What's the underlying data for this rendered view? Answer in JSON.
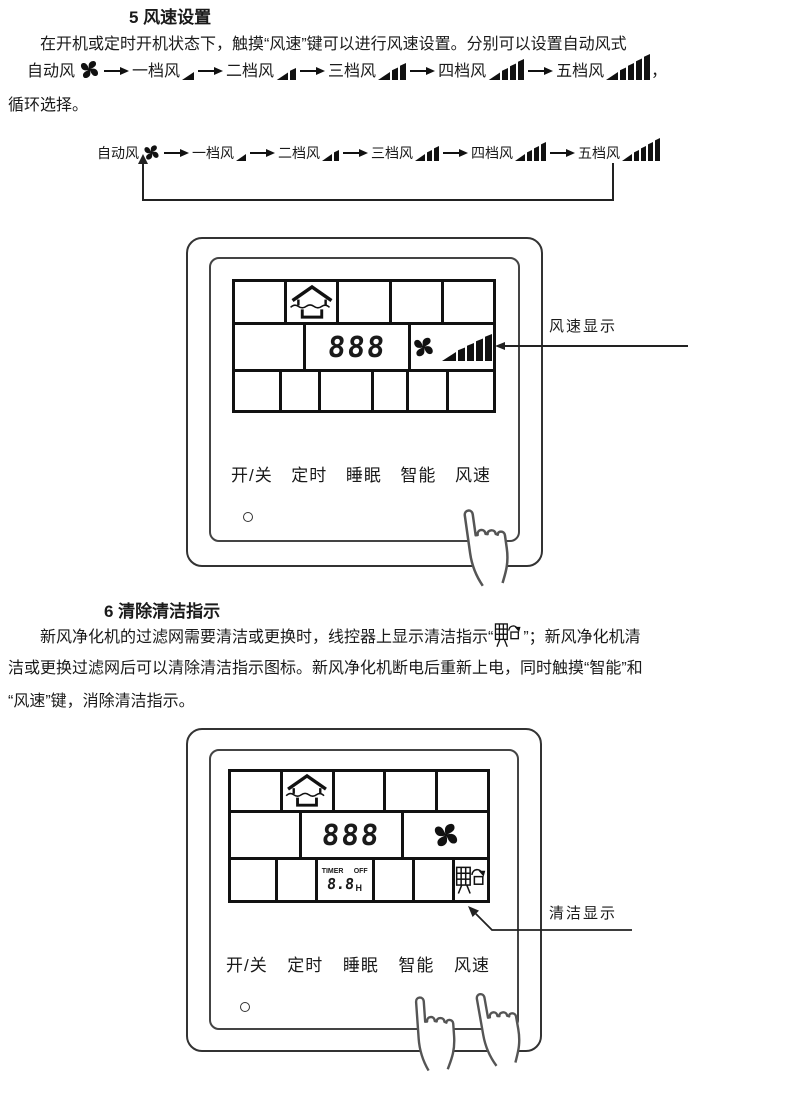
{
  "section5": {
    "heading": "5 风速设置",
    "para_line1": "在开机或定时开机状态下，触摸“风速”键可以进行风速设置。分别可以设置自动风式",
    "trailing_comma": "，",
    "para_line3": "循环选择。"
  },
  "speed_sequence": {
    "items": [
      {
        "label": "自动风",
        "icon": "fan-icon"
      },
      {
        "label": "一档风",
        "icon": "speed-bars-1-icon"
      },
      {
        "label": "二档风",
        "icon": "speed-bars-2-icon"
      },
      {
        "label": "三档风",
        "icon": "speed-bars-3-icon"
      },
      {
        "label": "四档风",
        "icon": "speed-bars-4-icon"
      },
      {
        "label": "五档风",
        "icon": "speed-bars-5-icon"
      }
    ]
  },
  "section6": {
    "heading": "6 清除清洁指示",
    "line1a": "新风净化机的过滤网需要清洁或更换时，线控器上显示清洁指示“",
    "line1_icon": "filter-clean-icon",
    "line1b": "”；新风净化机清",
    "line2": "洁或更换过滤网后可以清除清洁指示图标。新风净化机断电后重新上电，同时触摸“智能”和",
    "line3": "“风速”键，消除清洁指示。"
  },
  "panel1": {
    "display": {
      "digits": "888",
      "mode_icon": "house-airflow-icon",
      "fan_icon": "fan-icon",
      "bars_icon": "speed-bars-5-icon"
    },
    "buttons": [
      "开/关",
      "定时",
      "睡眠",
      "智能",
      "风速"
    ],
    "callout": "风速显示"
  },
  "panel2": {
    "display": {
      "digits": "888",
      "mode_icon": "house-airflow-icon",
      "fan_icon": "fan-icon",
      "timer_label": "TIMER",
      "timer_off": "OFF",
      "timer_digits": "8.8",
      "timer_unit": "H",
      "clean_icon": "filter-clean-icon"
    },
    "buttons": [
      "开/关",
      "定时",
      "睡眠",
      "智能",
      "风速"
    ],
    "callout": "清洁显示"
  },
  "colors": {
    "ink": "#1a1a1a",
    "lcd_line": "#111111"
  }
}
